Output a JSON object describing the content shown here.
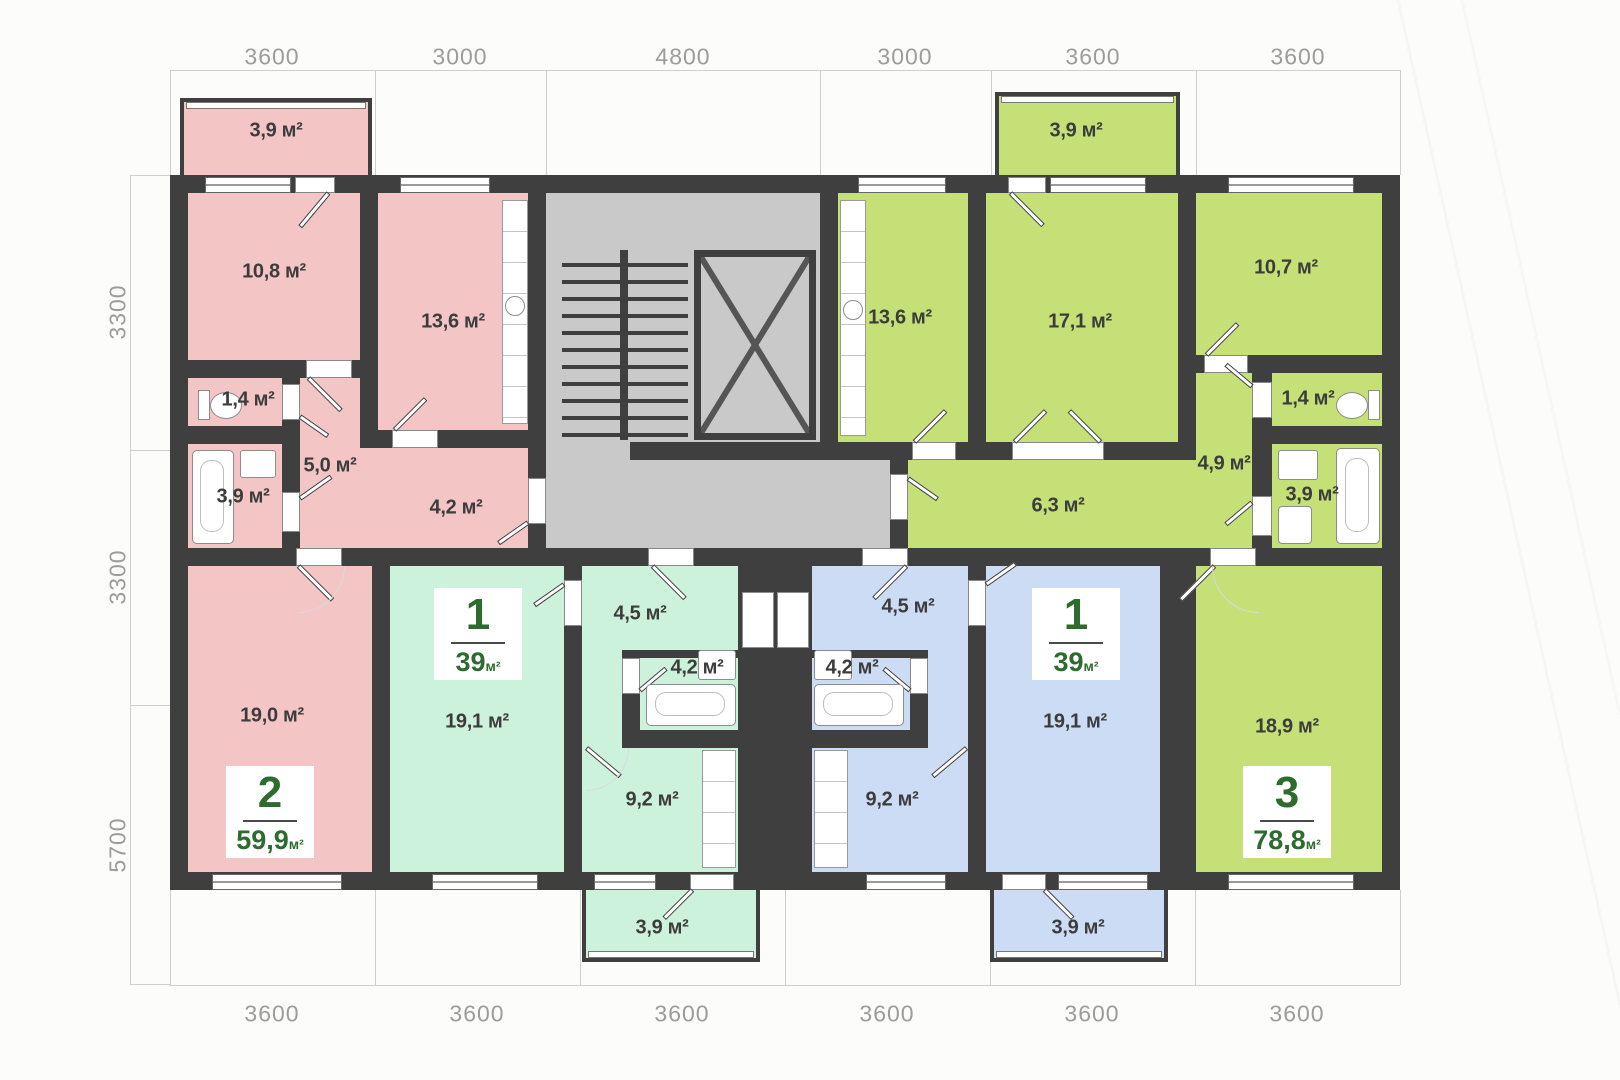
{
  "plan": {
    "dimensions": {
      "top": [
        "3600",
        "3000",
        "4800",
        "3000",
        "3600",
        "3600"
      ],
      "left": [
        "3300",
        "3300",
        "5700"
      ],
      "bottom": [
        "3600",
        "3600",
        "3600",
        "3600",
        "3600",
        "3600"
      ]
    },
    "apartments": {
      "pink": {
        "type_number": "2",
        "total_area": "59,9",
        "area_unit": "м²",
        "rooms": {
          "balcony": "3,9 м²",
          "bedroom": "10,8 м²",
          "kitchen": "13,6 м²",
          "wc": "1,4 м²",
          "bathroom": "3,9 м²",
          "hall": "5,0 м²",
          "corridor": "4,2 м²",
          "living": "19,0 м²"
        }
      },
      "mint": {
        "type_number": "1",
        "total_area": "39",
        "area_unit": "м²",
        "rooms": {
          "room": "19,1 м²",
          "hall": "4,5 м²",
          "bathroom": "4,2 м²",
          "kitchen": "9,2 м²",
          "balcony": "3,9 м²"
        }
      },
      "blue": {
        "type_number": "1",
        "total_area": "39",
        "area_unit": "м²",
        "rooms": {
          "room": "19,1 м²",
          "hall": "4,5 м²",
          "bathroom": "4,2 м²",
          "kitchen": "9,2 м²",
          "balcony": "3,9 м²"
        }
      },
      "lime": {
        "type_number": "3",
        "total_area": "78,8",
        "area_unit": "м²",
        "rooms": {
          "balcony": "3,9 м²",
          "kitchen": "13,6 м²",
          "living": "17,1 м²",
          "bedroom": "10,7 м²",
          "wc": "1,4 м²",
          "hall": "4,9 м²",
          "bathroom": "3,9 м²",
          "corridor": "6,3 м²",
          "room": "18,9 м²"
        }
      }
    },
    "colors": {
      "wall": "#3f3f3f",
      "pink": "#f3c5c5",
      "mint": "#cdf2dc",
      "blue": "#cddcf5",
      "lime": "#c4e077",
      "core_gray": "#c9c9c9",
      "badge_text": "#2e6b2e",
      "dim_text": "#9c9c9c",
      "label_text": "#3c3c3c"
    }
  }
}
